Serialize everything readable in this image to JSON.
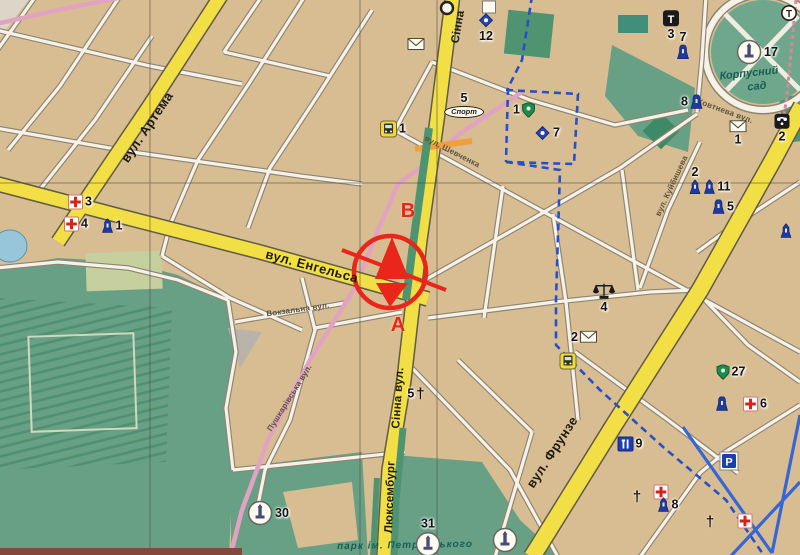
{
  "colors": {
    "background_tan": "#d8bd92",
    "main_road_yellow": "#f2de45",
    "park_green": "#68a086",
    "boulevard_green": "#4f9471",
    "minor_street_white": "#f6f2e7",
    "pink_road": "#e2a2c2",
    "transit_route_blue": "#2750c8",
    "grid_line": "#4a453c",
    "position_marker_red": "#e8261a",
    "poi_icon_blue": "#1e3a9e",
    "water_blue": "#97c6da"
  },
  "route_marker": {
    "letter_top": "В",
    "letter_bottom": "А"
  },
  "labels": [
    {
      "text": "вул. Артема",
      "x": 147,
      "y": 127,
      "rot": -56,
      "cls": "road",
      "name": "street-label-artema"
    },
    {
      "text": "вул. Енгельса",
      "x": 312,
      "y": 266,
      "rot": 15,
      "cls": "road",
      "name": "street-label-engelsa"
    },
    {
      "text": "Сінна",
      "x": 459,
      "y": 27,
      "rot": -80,
      "cls": "road-sm",
      "name": "street-label-sinna-top"
    },
    {
      "text": "Сінна вул.",
      "x": 399,
      "y": 398,
      "rot": -86,
      "cls": "road-sm",
      "name": "street-label-sinna"
    },
    {
      "text": "Люксембург",
      "x": 391,
      "y": 497,
      "rot": -88,
      "cls": "road-sm",
      "name": "street-label-luxemburg"
    },
    {
      "text": "вул. Фрунзе",
      "x": 552,
      "y": 452,
      "rot": -57,
      "cls": "road",
      "name": "street-label-frunze"
    },
    {
      "text": "вул. Шевченка",
      "x": 452,
      "y": 152,
      "rot": 27,
      "cls": "small",
      "name": "street-label-shevchenka"
    },
    {
      "text": "вул. Куйбишева",
      "x": 672,
      "y": 186,
      "rot": -65,
      "cls": "small",
      "name": "street-label-kuibysheva"
    },
    {
      "text": "Жовтнева вул.",
      "x": 724,
      "y": 111,
      "rot": 20,
      "cls": "small",
      "name": "street-label-zhovtneva"
    },
    {
      "text": "Вокзальна вул.",
      "x": 298,
      "y": 310,
      "rot": -8,
      "cls": "small",
      "name": "street-label-vokzalna"
    },
    {
      "text": "Пушкарівська вул.",
      "x": 290,
      "y": 398,
      "rot": -58,
      "cls": "small",
      "name": "street-label-pushkarivska"
    },
    {
      "text": "Корпусний",
      "x": 749,
      "y": 74,
      "rot": -6,
      "cls": "park",
      "name": "park-label-korpusnyi"
    },
    {
      "text": "сад",
      "x": 757,
      "y": 87,
      "rot": -6,
      "cls": "park",
      "name": "park-label-sad"
    },
    {
      "text": "парк ім. Петровського",
      "x": 405,
      "y": 546,
      "rot": -1,
      "cls": "park-bottom",
      "name": "park-label-petrovskoho"
    },
    {
      "text": "В",
      "x": 408,
      "y": 211,
      "rot": 0,
      "cls": "route-letter",
      "name": "route-point-b-label"
    },
    {
      "text": "А",
      "x": 398,
      "y": 325,
      "rot": 0,
      "cls": "route-letter",
      "name": "route-point-a-label"
    }
  ],
  "markers": [
    {
      "type": "hospital-cross",
      "x": 80,
      "y": 202,
      "num": "3",
      "pos": "right"
    },
    {
      "type": "hospital-cross",
      "x": 76,
      "y": 224,
      "num": "4",
      "pos": "right"
    },
    {
      "type": "monument",
      "x": 112,
      "y": 226,
      "num": "1",
      "pos": "right"
    },
    {
      "type": "bus-station",
      "x": 393,
      "y": 129,
      "num": "1",
      "pos": "right"
    },
    {
      "type": "envelope",
      "x": 416,
      "y": 44
    },
    {
      "type": "sport-oval",
      "x": 464,
      "y": 105,
      "num": "5",
      "pos": "above",
      "label": "Спорт"
    },
    {
      "type": "shield",
      "x": 524,
      "y": 110,
      "num": "1",
      "pos": "left"
    },
    {
      "type": "diamond",
      "x": 486,
      "y": 27,
      "num": "12",
      "pos": "below"
    },
    {
      "type": "diamond",
      "x": 547,
      "y": 133,
      "num": "7",
      "pos": "right"
    },
    {
      "type": "theater",
      "x": 671,
      "y": 25,
      "num": "3",
      "pos": "below",
      "glyph": "Т"
    },
    {
      "type": "bell",
      "x": 683,
      "y": 45,
      "num": "7",
      "pos": "above"
    },
    {
      "type": "bell",
      "x": 692,
      "y": 102,
      "num": "8",
      "pos": "left"
    },
    {
      "type": "circle-monument",
      "x": 757,
      "y": 52,
      "num": "17",
      "pos": "right"
    },
    {
      "type": "circled-t",
      "x": 789,
      "y": 13,
      "glyph": "Т"
    },
    {
      "type": "envelope",
      "x": 738,
      "y": 133,
      "num": "1",
      "pos": "below"
    },
    {
      "type": "phone",
      "x": 782,
      "y": 128,
      "num": "2",
      "pos": "below"
    },
    {
      "type": "monument",
      "x": 695,
      "y": 180,
      "num": "2",
      "pos": "above"
    },
    {
      "type": "monument",
      "x": 717,
      "y": 187,
      "num": "11",
      "pos": "right"
    },
    {
      "type": "bell",
      "x": 723,
      "y": 207,
      "num": "5",
      "pos": "right"
    },
    {
      "type": "monument",
      "x": 786,
      "y": 231
    },
    {
      "type": "scales",
      "x": 604,
      "y": 298,
      "num": "4",
      "pos": "below"
    },
    {
      "type": "envelope",
      "x": 584,
      "y": 337,
      "num": "2",
      "pos": "left"
    },
    {
      "type": "bus-station",
      "x": 568,
      "y": 361
    },
    {
      "type": "restaurant",
      "x": 630,
      "y": 444,
      "num": "9",
      "pos": "right"
    },
    {
      "type": "church-cross",
      "x": 416,
      "y": 394,
      "num": "5",
      "pos": "left",
      "glyph": "†"
    },
    {
      "type": "church-cross",
      "x": 637,
      "y": 497,
      "glyph": "†"
    },
    {
      "type": "hospital-cross",
      "x": 661,
      "y": 492
    },
    {
      "type": "shield",
      "x": 731,
      "y": 372,
      "num": "27",
      "pos": "right"
    },
    {
      "type": "bell",
      "x": 722,
      "y": 404
    },
    {
      "type": "hospital-cross",
      "x": 755,
      "y": 404,
      "num": "6",
      "pos": "right"
    },
    {
      "type": "parking",
      "x": 729,
      "y": 461,
      "glyph": "Р"
    },
    {
      "type": "monument",
      "x": 668,
      "y": 505,
      "num": "8",
      "pos": "right"
    },
    {
      "type": "circle-monument",
      "x": 268,
      "y": 513,
      "num": "30",
      "pos": "right"
    },
    {
      "type": "circle-monument",
      "x": 428,
      "y": 537,
      "num": "31",
      "pos": "above"
    },
    {
      "type": "circle-monument",
      "x": 505,
      "y": 540
    },
    {
      "type": "hospital-cross",
      "x": 745,
      "y": 521
    },
    {
      "type": "church-cross",
      "x": 710,
      "y": 522,
      "glyph": "†"
    },
    {
      "type": "white-box",
      "x": 489,
      "y": 7
    },
    {
      "type": "ring",
      "x": 447,
      "y": 8
    }
  ]
}
